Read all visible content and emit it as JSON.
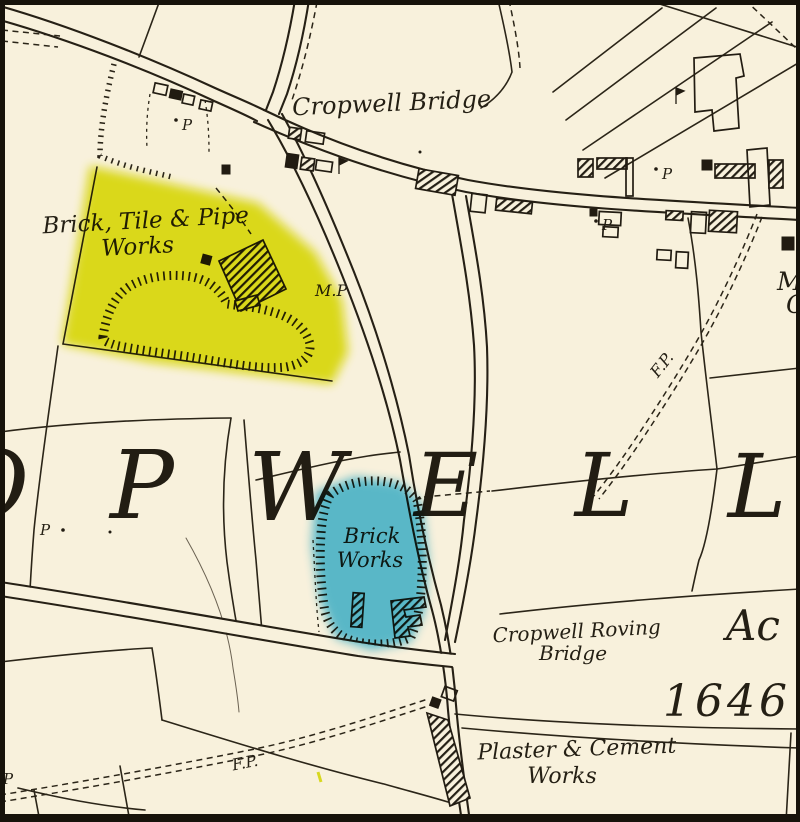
{
  "map": {
    "parish_letters": [
      "O",
      "P",
      "W",
      "E",
      "L",
      "L"
    ],
    "labels": {
      "cropwell_bridge": "Cropwell Bridge",
      "brick_tile_pipe_line1": "Brick, Tile & Pipe",
      "brick_tile_pipe_line2": "Works",
      "milepost": "M.P",
      "pump": "P",
      "footpath": "F.P.",
      "brick_works_line1": "Brick",
      "brick_works_line2": "Works",
      "roving_bridge_line1": "Cropwell Roving",
      "roving_bridge_line2": "Bridge",
      "acreage": "Ac",
      "parcel_number": "1646",
      "plaster_cement_line1": "Plaster & Cement",
      "plaster_cement_line2": "Works",
      "edge_m": "M",
      "edge_c": "C"
    },
    "colors": {
      "background": "#f8f1dc",
      "ink": "#2b2518",
      "highlight_yellow": "#dfe30e",
      "highlight_blue": "#52bfe6",
      "border": "#17130b"
    }
  }
}
